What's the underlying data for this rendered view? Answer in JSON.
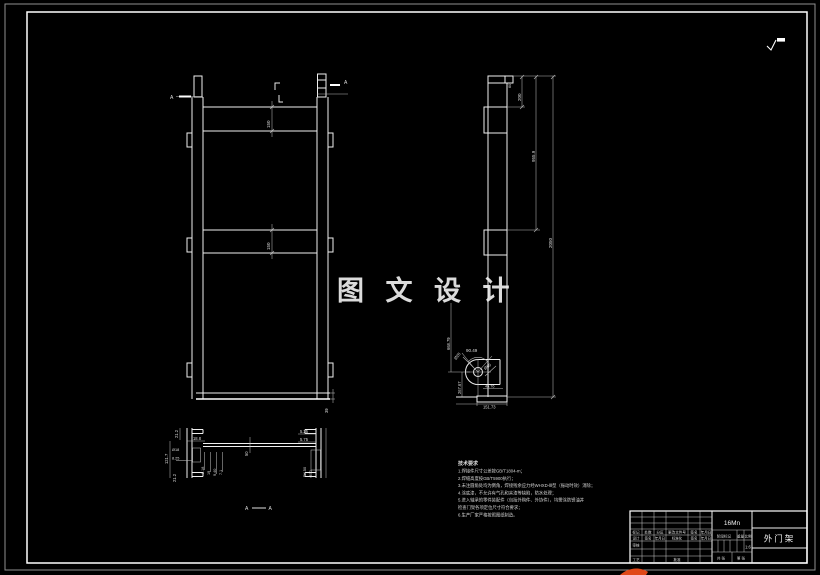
{
  "watermark": {
    "text": "图 文 设 计"
  },
  "front_view": {
    "section_label_left": "A",
    "section_label_right": "A",
    "dim_crossbar_top": "150",
    "dim_crossbar_mid": "150",
    "dim_base": "39"
  },
  "side_view": {
    "dim_top_small": "60",
    "dim_top": "200",
    "dim_upper": "955.9",
    "dim_total": "2050",
    "dim_angle": "90.49",
    "dim_pin": "Ø28",
    "dim_hole": "Ø60",
    "dim_foot_offset": "45.76",
    "dim_lower": "668.79",
    "dim_bottom_offset": "267.67",
    "dim_base_width": "151.73"
  },
  "section_view": {
    "label_a1": "A",
    "label_a2": "A",
    "dim_web": "50",
    "left": {
      "d1": "21.2",
      "d2": "18.8",
      "d3": "121.7",
      "d4": "Ø18",
      "d5": "8.25",
      "d6": "9.18",
      "d7": "19",
      "d8": "9.40",
      "d9": "7.1",
      "d10": "21.2"
    },
    "right": {
      "d1": "5.25",
      "d2": "5.75",
      "d3": "R4.50",
      "d4": "Ø30"
    }
  },
  "notes": {
    "title": "技术要求",
    "lines": [
      "1.焊接件尺寸公差按GB/T1804-m；",
      "2.焊缝高度按GB/T5900执行；",
      "3.未注圆角处均为倒角，焊接残余应力经WHXD-Ⅲ型（振动时效）消除；",
      "4.涂底漆，不允许有气孔和夹渣等缺陷，防水处理；",
      "5.进入轴承的零件装配件（包括外购件、外协件），均需涂防锈油并",
      "检查门架各项定位尺寸符合要求；",
      "6.生产厂家严格按照图纸制造。"
    ]
  },
  "title_block": {
    "material": "16Mn",
    "part_name": "外门架",
    "scale_value": "1:6",
    "labels": {
      "stage": "阶段标记",
      "weight": "重量",
      "scale": "比例",
      "sheets_total": "共 张",
      "sheet_no": "第 张",
      "mark": "标记",
      "count": "处数",
      "zone": "分区",
      "doc_no": "更改文件号",
      "sign": "签名",
      "date": "年月日",
      "design": "设计",
      "standard": "标准化",
      "check": "审核",
      "process": "工艺",
      "approve": "批准"
    }
  }
}
